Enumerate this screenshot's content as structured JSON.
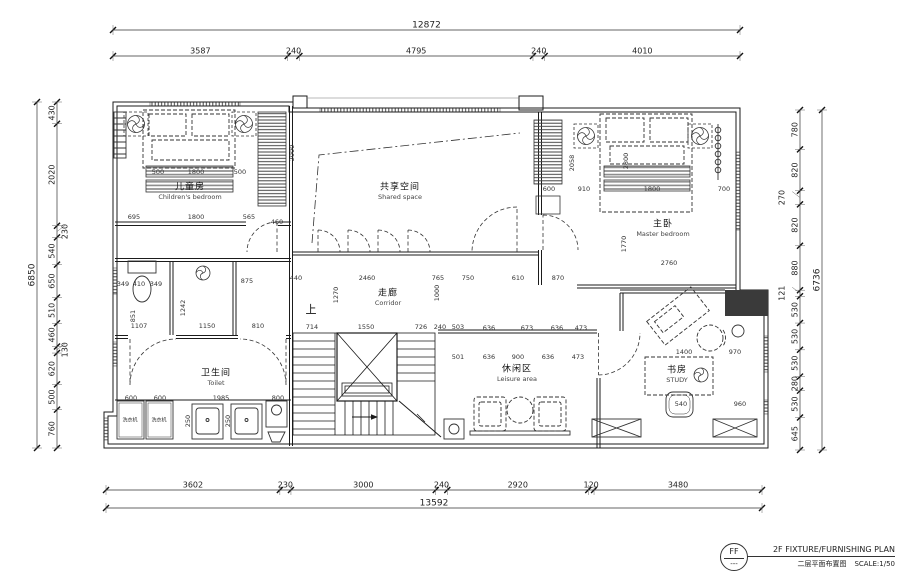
{
  "title_block": {
    "stamp_code": "FF",
    "stamp_sub": "---",
    "title_en": "2F FIXTURE/FURNISHING PLAN",
    "title_cn": "二层平面布置图",
    "scale_label": "SCALE:1/50"
  },
  "dimensions": {
    "top": {
      "total": "12872",
      "segments": [
        "3587",
        "240",
        "4795",
        "240",
        "4010"
      ]
    },
    "bottom": {
      "total": "13592",
      "segments": [
        "3602",
        "230",
        "3000",
        "240",
        "2920",
        "120",
        "3480"
      ]
    },
    "left": {
      "total": "6850",
      "segments": [
        "430",
        "2020",
        "230",
        "540",
        "650",
        "510",
        "460",
        "130",
        "620",
        "500",
        "760"
      ]
    },
    "right": {
      "total": "6736",
      "segments": [
        "780",
        "820",
        "270",
        "820",
        "880",
        "121",
        "530",
        "530",
        "530",
        "280",
        "530",
        "645"
      ]
    }
  },
  "rooms": [
    {
      "cn": "儿童房",
      "en": "Children's bedroom",
      "x": 190,
      "y": 186
    },
    {
      "cn": "共享空间",
      "en": "Shared space",
      "x": 400,
      "y": 186
    },
    {
      "cn": "主卧",
      "en": "Master bedroom",
      "x": 663,
      "y": 223
    },
    {
      "cn": "走廊",
      "en": "Corridor",
      "x": 388,
      "y": 292
    },
    {
      "cn": "卫生间",
      "en": "Toilet",
      "x": 216,
      "y": 372
    },
    {
      "cn": "休闲区",
      "en": "Leisure area",
      "x": 517,
      "y": 368
    },
    {
      "cn": "书房",
      "en": "STUDY",
      "x": 677,
      "y": 369
    }
  ],
  "misc_labels": [
    {
      "t": "上",
      "x": 311,
      "y": 309,
      "k": "cn-lg",
      "n": "stair-up-label"
    },
    {
      "t": "洗衣机",
      "x": 130,
      "y": 420,
      "k": "tiny",
      "n": "washing-machine-label"
    },
    {
      "t": "洗衣机",
      "x": 159,
      "y": 420,
      "k": "tiny",
      "n": "washing-machine-label"
    }
  ],
  "interior_dims": [
    {
      "t": "500",
      "x": 158,
      "y": 172
    },
    {
      "t": "1800",
      "x": 196,
      "y": 172
    },
    {
      "t": "500",
      "x": 240,
      "y": 172
    },
    {
      "t": "695",
      "x": 134,
      "y": 217
    },
    {
      "t": "1800",
      "x": 196,
      "y": 217
    },
    {
      "t": "565",
      "x": 249,
      "y": 217
    },
    {
      "t": "460",
      "x": 277,
      "y": 222
    },
    {
      "t": "2000",
      "x": 292,
      "y": 153,
      "r": -90
    },
    {
      "t": "600",
      "x": 549,
      "y": 189
    },
    {
      "t": "910",
      "x": 584,
      "y": 189
    },
    {
      "t": "1800",
      "x": 652,
      "y": 189
    },
    {
      "t": "700",
      "x": 724,
      "y": 189
    },
    {
      "t": "2058",
      "x": 572,
      "y": 163,
      "r": -90
    },
    {
      "t": "2800",
      "x": 626,
      "y": 161,
      "r": -90
    },
    {
      "t": "1770",
      "x": 624,
      "y": 244,
      "r": -90
    },
    {
      "t": "2760",
      "x": 669,
      "y": 263
    },
    {
      "t": "440",
      "x": 296,
      "y": 278
    },
    {
      "t": "2460",
      "x": 367,
      "y": 278
    },
    {
      "t": "765",
      "x": 438,
      "y": 278
    },
    {
      "t": "750",
      "x": 468,
      "y": 278
    },
    {
      "t": "610",
      "x": 518,
      "y": 278
    },
    {
      "t": "870",
      "x": 558,
      "y": 278
    },
    {
      "t": "1270",
      "x": 336,
      "y": 295,
      "r": -90
    },
    {
      "t": "1000",
      "x": 437,
      "y": 293,
      "r": -90
    },
    {
      "t": "714",
      "x": 312,
      "y": 327
    },
    {
      "t": "1550",
      "x": 366,
      "y": 327
    },
    {
      "t": "726",
      "x": 421,
      "y": 327
    },
    {
      "t": "240",
      "x": 440,
      "y": 327
    },
    {
      "t": "503",
      "x": 458,
      "y": 327
    },
    {
      "t": "636",
      "x": 489,
      "y": 328
    },
    {
      "t": "673",
      "x": 527,
      "y": 328
    },
    {
      "t": "636",
      "x": 557,
      "y": 328
    },
    {
      "t": "473",
      "x": 581,
      "y": 328
    },
    {
      "t": "501",
      "x": 458,
      "y": 357
    },
    {
      "t": "636",
      "x": 489,
      "y": 357
    },
    {
      "t": "900",
      "x": 518,
      "y": 357
    },
    {
      "t": "636",
      "x": 548,
      "y": 357
    },
    {
      "t": "473",
      "x": 578,
      "y": 357
    },
    {
      "t": "349",
      "x": 123,
      "y": 284
    },
    {
      "t": "410",
      "x": 139,
      "y": 284
    },
    {
      "t": "349",
      "x": 156,
      "y": 284
    },
    {
      "t": "875",
      "x": 247,
      "y": 281
    },
    {
      "t": "851",
      "x": 133,
      "y": 316,
      "r": -90
    },
    {
      "t": "1242",
      "x": 183,
      "y": 308,
      "r": -90
    },
    {
      "t": "1107",
      "x": 139,
      "y": 326
    },
    {
      "t": "1150",
      "x": 207,
      "y": 326
    },
    {
      "t": "810",
      "x": 258,
      "y": 326
    },
    {
      "t": "600",
      "x": 131,
      "y": 398
    },
    {
      "t": "600",
      "x": 160,
      "y": 398
    },
    {
      "t": "1985",
      "x": 221,
      "y": 398
    },
    {
      "t": "800",
      "x": 278,
      "y": 398
    },
    {
      "t": "250",
      "x": 188,
      "y": 421,
      "r": -90
    },
    {
      "t": "250",
      "x": 228,
      "y": 421,
      "r": -90
    },
    {
      "t": "1400",
      "x": 684,
      "y": 352
    },
    {
      "t": "970",
      "x": 735,
      "y": 352
    },
    {
      "t": "540",
      "x": 681,
      "y": 404
    },
    {
      "t": "960",
      "x": 740,
      "y": 404
    }
  ],
  "colors": {
    "line": "#1b1b1b",
    "furniture": "#333333",
    "band": "#8a8a8a",
    "background": "#ffffff"
  }
}
